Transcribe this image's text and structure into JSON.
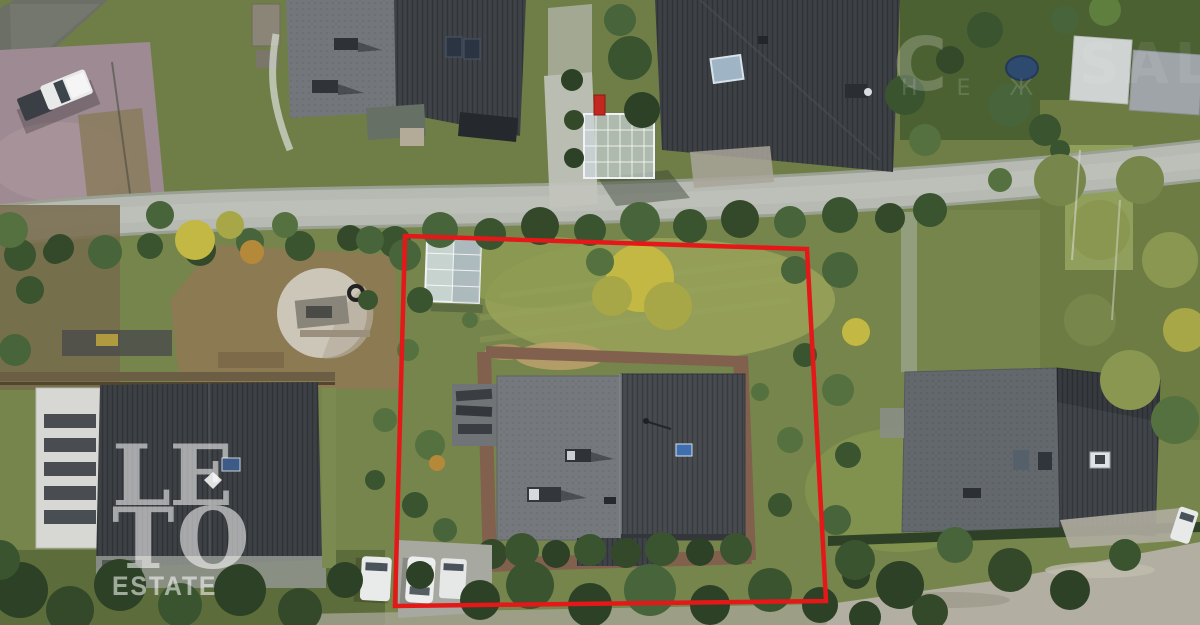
{
  "watermarks": {
    "logo": {
      "line1": "LE",
      "line2": "TO",
      "line3": "ESTATE"
    },
    "corner": {
      "big_left": "C",
      "big_right": "SALT",
      "small_row": "Н Е Ж"
    }
  },
  "boundary": {
    "color": "#e41818"
  },
  "palette": {
    "lawn": "#76854b",
    "road_asphalt": "#b6bab2",
    "roof_dark": "#42464b",
    "roof_light": "#75797d",
    "brick_path": "#82604e",
    "paver_driveway": "#9d8a92",
    "autumn_yellow": "#c3b843",
    "greenhouse_glass": "#d6e0e6"
  }
}
